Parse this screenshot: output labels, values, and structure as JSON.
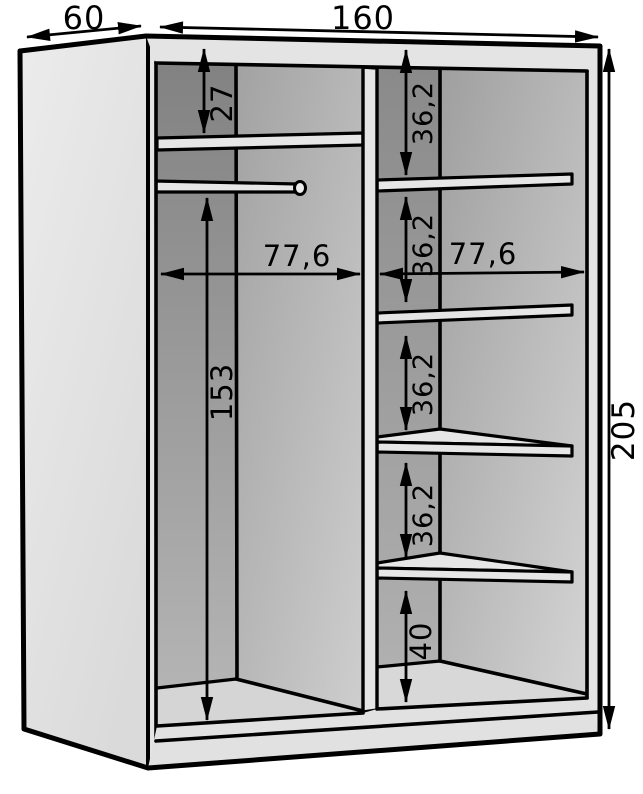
{
  "diagram": {
    "dimensions": {
      "depth": "60",
      "width": "160",
      "height": "205",
      "left_compartment_width": "77,6",
      "right_compartment_width": "77,6",
      "top_shelf_drop": "27",
      "hanging_space_height": "153",
      "shelf_gaps": [
        "36,2",
        "36,2",
        "36,2",
        "36,2"
      ],
      "bottom_shelf_gap": "40"
    },
    "colors": {
      "background": "#ffffff",
      "line": "#000000",
      "panel_light": "#e4e4e4",
      "interior_dark": "#8a8a8a",
      "interior_light": "#d2d2d2"
    }
  }
}
